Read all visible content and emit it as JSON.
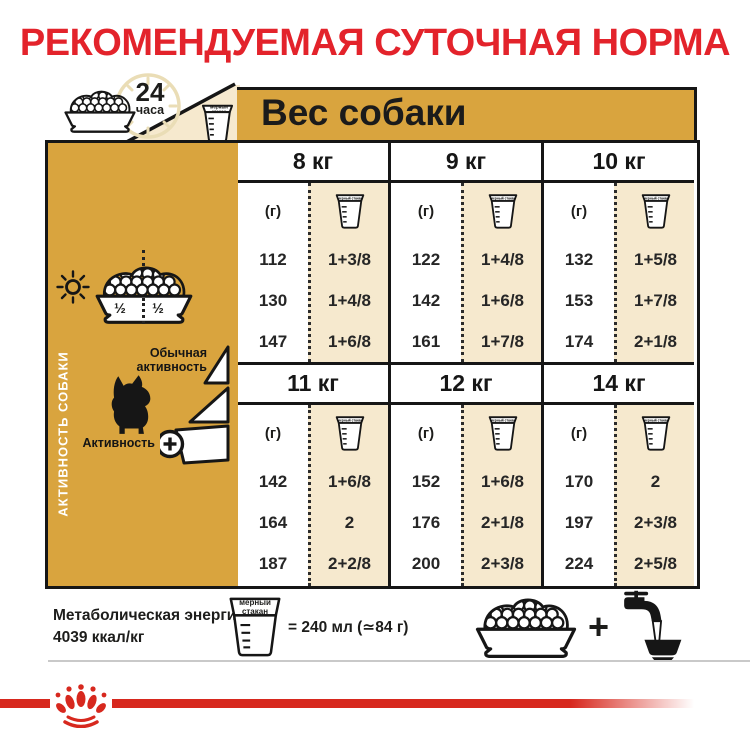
{
  "title": "РЕКОМЕНДУЕМАЯ СУТОЧНАЯ НОРМА",
  "top": {
    "hours_value": "24",
    "hours_unit": "часа",
    "weight_header": "Вес собаки",
    "cup_label": "мерный стакан"
  },
  "sidebar": {
    "vertical_label": "АКТИВНОСТЬ СОБАКИ",
    "bowl_half_left": "½",
    "bowl_half_right": "½",
    "normal_activity_label": "Обычная активность",
    "activity_plus_label": "Активность",
    "plus_symbol": "+"
  },
  "table": {
    "gram_unit": "(г)",
    "cup_label": "мерный стакан",
    "groups": [
      {
        "weight": "8 кг",
        "rows": [
          {
            "g": "112",
            "cups": "1+3/8"
          },
          {
            "g": "130",
            "cups": "1+4/8"
          },
          {
            "g": "147",
            "cups": "1+6/8"
          }
        ]
      },
      {
        "weight": "9 кг",
        "rows": [
          {
            "g": "122",
            "cups": "1+4/8"
          },
          {
            "g": "142",
            "cups": "1+6/8"
          },
          {
            "g": "161",
            "cups": "1+7/8"
          }
        ]
      },
      {
        "weight": "10 кг",
        "rows": [
          {
            "g": "132",
            "cups": "1+5/8"
          },
          {
            "g": "153",
            "cups": "1+7/8"
          },
          {
            "g": "174",
            "cups": "2+1/8"
          }
        ]
      },
      {
        "weight": "11 кг",
        "rows": [
          {
            "g": "142",
            "cups": "1+6/8"
          },
          {
            "g": "164",
            "cups": "2"
          },
          {
            "g": "187",
            "cups": "2+2/8"
          }
        ]
      },
      {
        "weight": "12 кг",
        "rows": [
          {
            "g": "152",
            "cups": "1+6/8"
          },
          {
            "g": "176",
            "cups": "2+1/8"
          },
          {
            "g": "200",
            "cups": "2+3/8"
          }
        ]
      },
      {
        "weight": "14 кг",
        "rows": [
          {
            "g": "170",
            "cups": "2"
          },
          {
            "g": "197",
            "cups": "2+3/8"
          },
          {
            "g": "224",
            "cups": "2+5/8"
          }
        ]
      }
    ]
  },
  "footer": {
    "energy_label": "Метаболическая энергия:",
    "energy_value": "4039 ккал/кг",
    "cup_label": "мерный стакан",
    "cup_equivalence": "= 240 мл (≃84 г)",
    "plus_symbol": "+"
  },
  "colors": {
    "accent_red": "#E3232B",
    "line_red": "#D7281E",
    "gold": "#D9A43E",
    "cream": "#F6E9CE",
    "ink": "#161616"
  }
}
